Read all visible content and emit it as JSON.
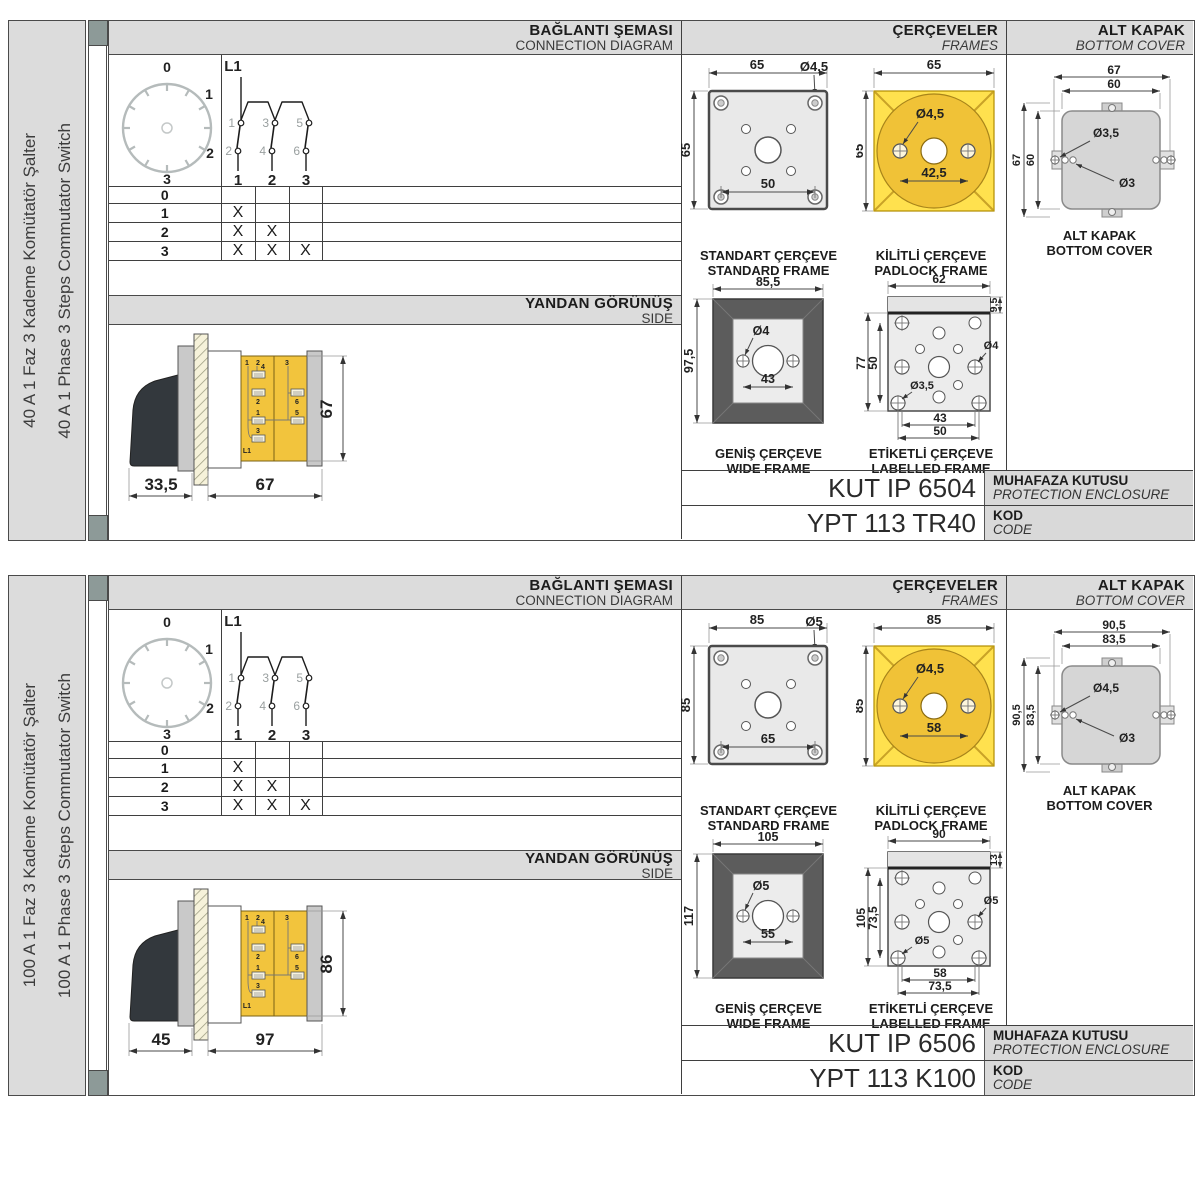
{
  "colors": {
    "accent_yellow": "#FFE14E",
    "circle_yellow": "#F0C237",
    "body_yellow": "#F2C43D",
    "panel_gray": "#DCDCDC",
    "line_dark": "#4A4A4A",
    "strip_cap": "#8D9A98"
  },
  "panels": [
    {
      "sidebar": {
        "line_tr": "40 A 1 Faz 3 Kademe Komütatör Şalter",
        "line_en": "40 A 1 Phase 3 Steps Commutator Switch"
      },
      "connection": {
        "title_tr": "BAĞLANTI ŞEMASI",
        "title_en": "CONNECTION DIAGRAM",
        "dial": {
          "p0": "0",
          "p1": "1",
          "p2": "2",
          "p3": "3"
        },
        "circuit": {
          "input": "L1",
          "t1": "1",
          "t2": "2",
          "t3": "3",
          "t4": "4",
          "t5": "5",
          "t6": "6",
          "o1": "1",
          "o2": "2",
          "o3": "3"
        },
        "table": {
          "rows": [
            {
              "pos": "0",
              "c1": "",
              "c2": "",
              "c3": ""
            },
            {
              "pos": "1",
              "c1": "X",
              "c2": "",
              "c3": ""
            },
            {
              "pos": "2",
              "c1": "X",
              "c2": "X",
              "c3": ""
            },
            {
              "pos": "3",
              "c1": "X",
              "c2": "X",
              "c3": "X"
            }
          ]
        }
      },
      "side": {
        "title_tr": "YANDAN GÖRÜNÜŞ",
        "title_en": "SIDE",
        "dim_handle": "33,5",
        "dim_depth": "67",
        "dim_height": "67",
        "labels": {
          "a": "1",
          "b": "2",
          "c": "4",
          "d": "2",
          "e": "1",
          "f": "3",
          "g": "L1",
          "h": "3",
          "i": "6",
          "j": "5"
        }
      },
      "frames": {
        "title_tr": "ÇERÇEVELER",
        "title_en": "FRAMES",
        "standard": {
          "label_tr": "STANDART ÇERÇEVE",
          "label_en": "STANDARD FRAME",
          "dim_w": "65",
          "dim_h": "65",
          "hole": "Ø4,5",
          "dim_inner": "50"
        },
        "padlock": {
          "label_tr": "KİLİTLİ ÇERÇEVE",
          "label_en": "PADLOCK FRAME",
          "dim_w": "65",
          "dim_h": "65",
          "hole": "Ø4,5",
          "dim_span": "42,5"
        },
        "wide": {
          "label_tr": "GENİŞ ÇERÇEVE",
          "label_en": "WIDE FRAME",
          "dim_w": "85,5",
          "dim_h": "97,5",
          "hole": "Ø4",
          "dim_span": "43"
        },
        "labelled": {
          "label_tr": "ETİKETLİ ÇERÇEVE",
          "label_en": "LABELLED FRAME",
          "dim_w": "62",
          "dim_band": "9,5",
          "dim_h": "77",
          "dim_h_inner": "50",
          "hole_r": "Ø4",
          "hole_b": "Ø3,5",
          "dim_span1": "43",
          "dim_span2": "50"
        }
      },
      "cover": {
        "title_tr": "ALT KAPAK",
        "title_en": "BOTTOM COVER",
        "caption_tr": "ALT KAPAK",
        "caption_en": "BOTTOM COVER",
        "dim_w_out": "67",
        "dim_w_in": "60",
        "dim_h_out": "67",
        "dim_h_in": "60",
        "hole1": "Ø3,5",
        "hole2": "Ø3"
      },
      "codes": {
        "enclosure_value": "KUT IP 6504",
        "enclosure_tr": "MUHAFAZA KUTUSU",
        "enclosure_en": "PROTECTION ENCLOSURE",
        "code_value": "YPT 113 TR40",
        "code_tr": "KOD",
        "code_en": "CODE"
      }
    },
    {
      "sidebar": {
        "line_tr": "100 A 1 Faz 3 Kademe Komütatör Şalter",
        "line_en": "100 A 1 Phase 3 Steps Commutator Switch"
      },
      "connection": {
        "title_tr": "BAĞLANTI ŞEMASI",
        "title_en": "CONNECTION DIAGRAM",
        "dial": {
          "p0": "0",
          "p1": "1",
          "p2": "2",
          "p3": "3"
        },
        "circuit": {
          "input": "L1",
          "t1": "1",
          "t2": "2",
          "t3": "3",
          "t4": "4",
          "t5": "5",
          "t6": "6",
          "o1": "1",
          "o2": "2",
          "o3": "3"
        },
        "table": {
          "rows": [
            {
              "pos": "0",
              "c1": "",
              "c2": "",
              "c3": ""
            },
            {
              "pos": "1",
              "c1": "X",
              "c2": "",
              "c3": ""
            },
            {
              "pos": "2",
              "c1": "X",
              "c2": "X",
              "c3": ""
            },
            {
              "pos": "3",
              "c1": "X",
              "c2": "X",
              "c3": "X"
            }
          ]
        }
      },
      "side": {
        "title_tr": "YANDAN GÖRÜNÜŞ",
        "title_en": "SIDE",
        "dim_handle": "45",
        "dim_depth": "97",
        "dim_height": "86",
        "labels": {
          "a": "1",
          "b": "2",
          "c": "4",
          "d": "2",
          "e": "1",
          "f": "3",
          "g": "L1",
          "h": "3",
          "i": "6",
          "j": "5"
        }
      },
      "frames": {
        "title_tr": "ÇERÇEVELER",
        "title_en": "FRAMES",
        "standard": {
          "label_tr": "STANDART ÇERÇEVE",
          "label_en": "STANDARD FRAME",
          "dim_w": "85",
          "dim_h": "85",
          "hole": "Ø5",
          "dim_inner": "65"
        },
        "padlock": {
          "label_tr": "KİLİTLİ ÇERÇEVE",
          "label_en": "PADLOCK FRAME",
          "dim_w": "85",
          "dim_h": "85",
          "hole": "Ø4,5",
          "dim_span": "58"
        },
        "wide": {
          "label_tr": "GENİŞ ÇERÇEVE",
          "label_en": "WIDE FRAME",
          "dim_w": "105",
          "dim_h": "117",
          "hole": "Ø5",
          "dim_span": "55"
        },
        "labelled": {
          "label_tr": "ETİKETLİ ÇERÇEVE",
          "label_en": "LABELLED FRAME",
          "dim_w": "90",
          "dim_band": "13",
          "dim_h": "105",
          "dim_h_inner": "73,5",
          "hole_r": "Ø5",
          "hole_b": "Ø5",
          "dim_span1": "58",
          "dim_span2": "73,5"
        }
      },
      "cover": {
        "title_tr": "ALT KAPAK",
        "title_en": "BOTTOM COVER",
        "caption_tr": "ALT KAPAK",
        "caption_en": "BOTTOM COVER",
        "dim_w_out": "90,5",
        "dim_w_in": "83,5",
        "dim_h_out": "90,5",
        "dim_h_in": "83,5",
        "hole1": "Ø4,5",
        "hole2": "Ø3"
      },
      "codes": {
        "enclosure_value": "KUT IP 6506",
        "enclosure_tr": "MUHAFAZA KUTUSU",
        "enclosure_en": "PROTECTION ENCLOSURE",
        "code_value": "YPT 113 K100",
        "code_tr": "KOD",
        "code_en": "CODE"
      }
    }
  ]
}
